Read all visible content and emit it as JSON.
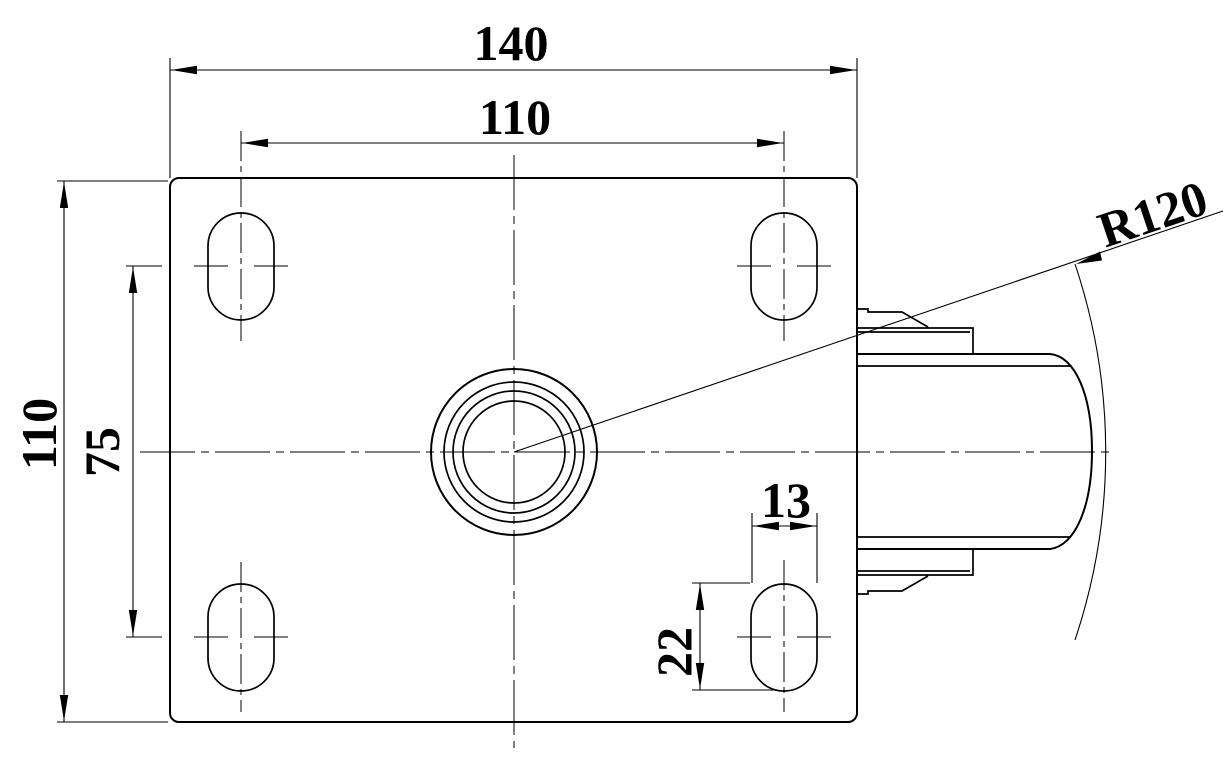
{
  "drawing": {
    "labels": {
      "plate_width": "140",
      "hole_spacing_x": "110",
      "plate_height": "110",
      "hole_spacing_y": "75",
      "slot_width": "13",
      "slot_length": "22",
      "swivel_radius": "R120"
    }
  }
}
